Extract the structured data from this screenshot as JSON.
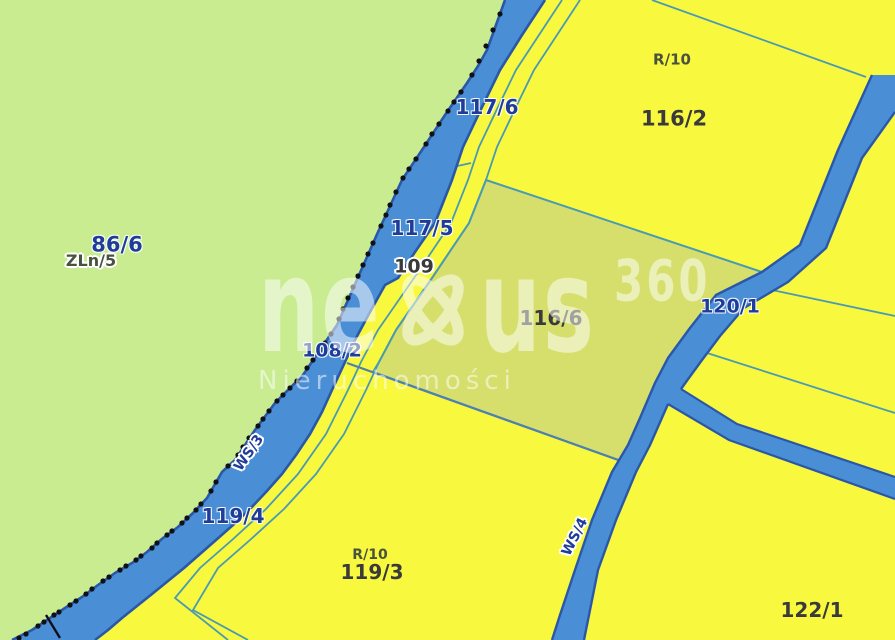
{
  "map": {
    "type": "cadastral-parcel-map",
    "watermark": {
      "brand_prefix": "ne",
      "brand_suffix": "us",
      "brand_sup": "360",
      "subtitle": "Nieruchomości"
    },
    "labels": {
      "p86_6": "86/6",
      "zln5": "ZLn/5",
      "p117_6": "117/6",
      "p117_5": "117/5",
      "p109": "109",
      "p108_2": "108/2",
      "p119_4": "119/4",
      "r10_top": "R/10",
      "p116_2": "116/2",
      "p116_6": "116/6",
      "p120_1": "120/1",
      "r10_bottom": "R/10",
      "p119_3": "119/3",
      "p122_1": "122/1",
      "ws3": "WS/3",
      "ws4": "WS/4"
    },
    "colors": {
      "field_yellow": "#f8f83e",
      "forest_green": "#c9ec90",
      "meadow_olive": "#d6de6c",
      "water_fill": "#4a8fd6",
      "water_edge": "#2a57a8",
      "boundary_teal": "#4a9ab2",
      "boundary_steel": "#4e7fb0",
      "survey_point": "#101018",
      "label_navy": "#1e3c9a",
      "label_dark": "#3a3a3a",
      "label_landuse": "#49523f",
      "watermark_white": "#ffffff"
    }
  }
}
